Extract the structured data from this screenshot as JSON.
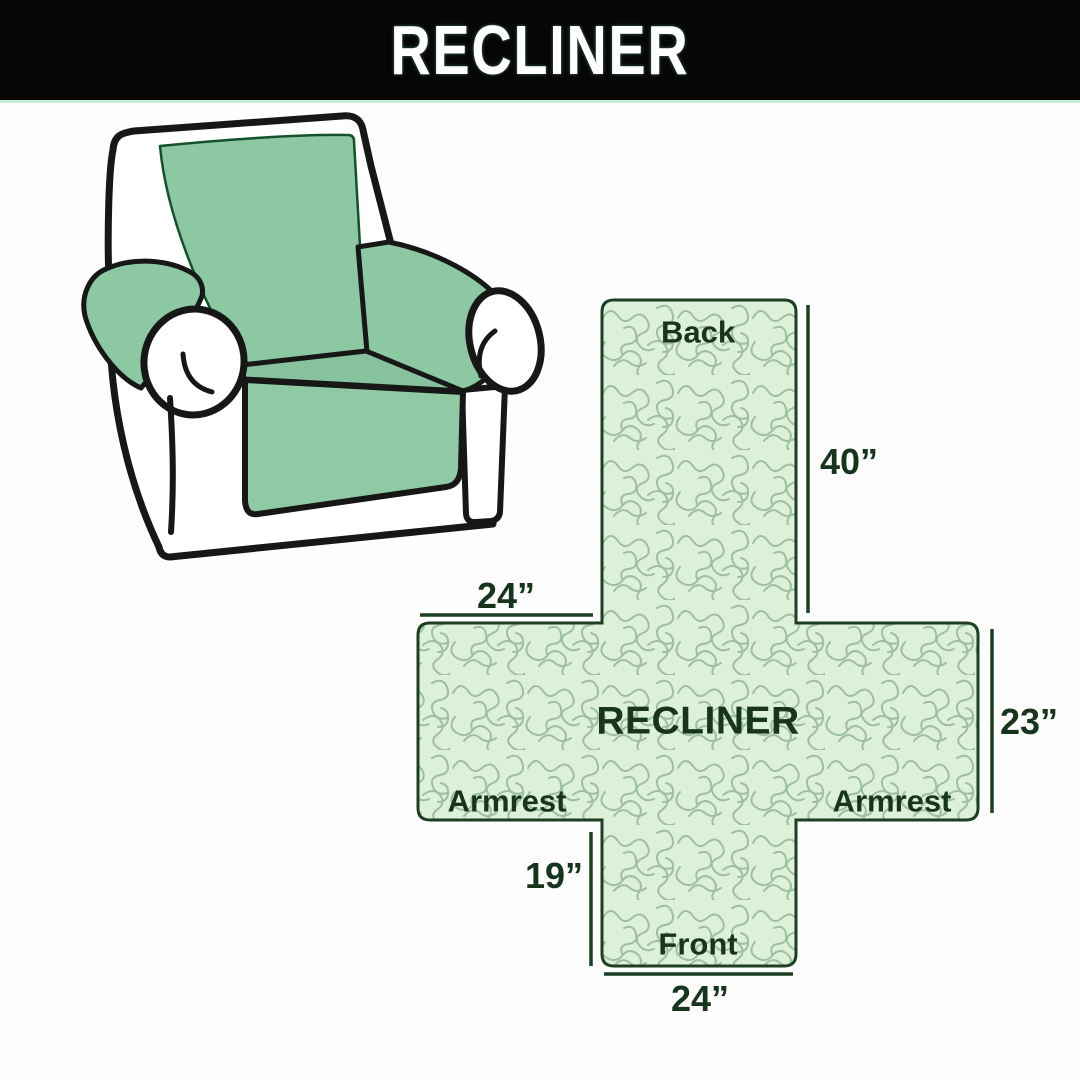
{
  "header": {
    "title": "RECLINER"
  },
  "illustration": {
    "description": "armchair with green protective slipcover on back, seat and armrests",
    "cover_color": "#8cc8a2",
    "body_color": "#ffffff",
    "outline_color": "#171717"
  },
  "diagram": {
    "center_label": "RECLINER",
    "back_label": "Back",
    "front_label": "Front",
    "armrest_left_label": "Armrest",
    "armrest_right_label": "Armrest",
    "dim_back_height": "40”",
    "dim_armrest_width": "24”",
    "dim_side_height": "23”",
    "dim_front_height": "19”",
    "dim_front_width": "24”",
    "fill_color": "#ddf1da",
    "pattern_line_color": "#9ebfa0",
    "outline_color": "#1d4023",
    "label_color": "#17351c"
  }
}
